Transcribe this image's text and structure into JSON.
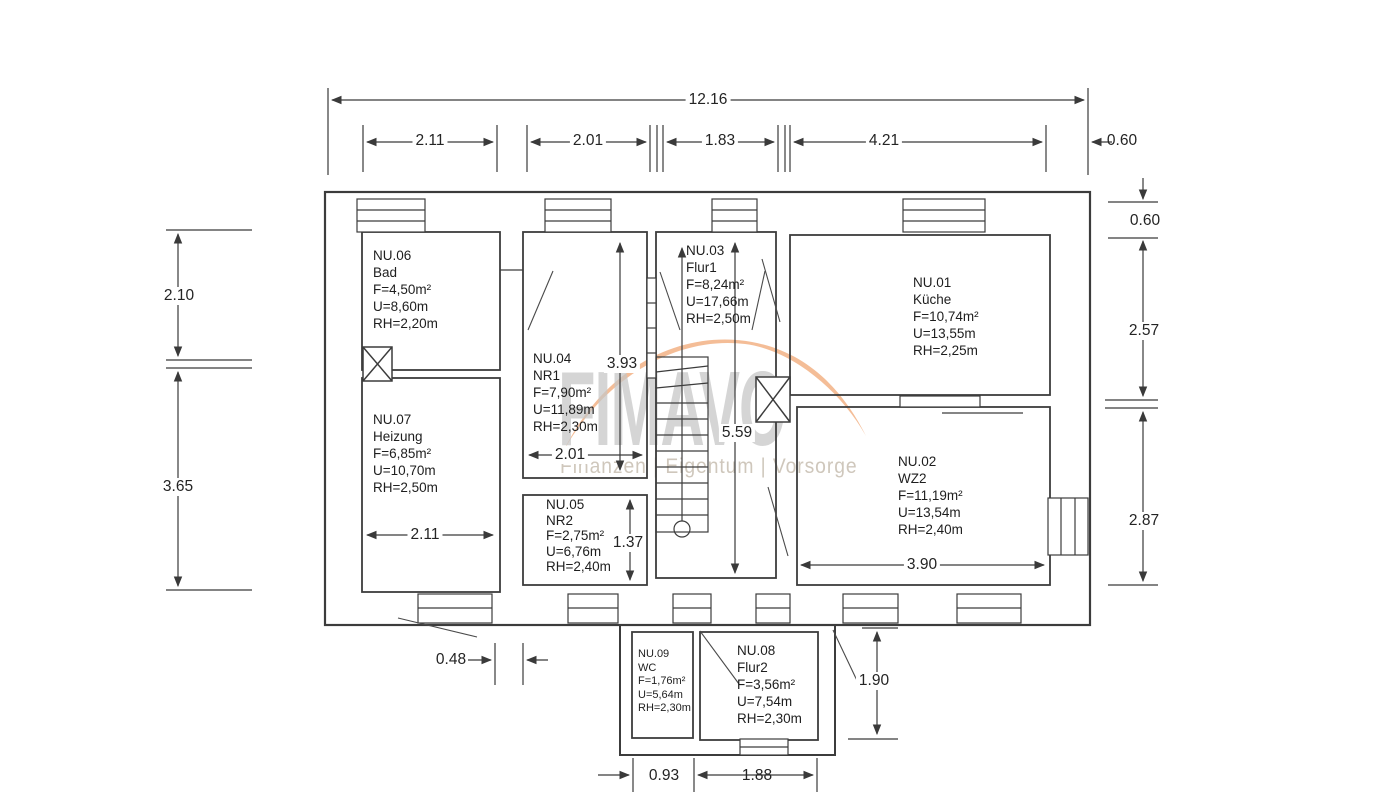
{
  "watermark": {
    "brand": "FIMAVO",
    "tagline": "Finanzen | Eigentum | Vorsorge",
    "accent_color": "#f2b285",
    "text_color": "#c6c6c6"
  },
  "rooms": {
    "nu01": {
      "id": "NU.01",
      "name": "Küche",
      "area": "F=10,74m²",
      "perimeter": "U=13,55m",
      "height": "RH=2,25m"
    },
    "nu02": {
      "id": "NU.02",
      "name": "WZ2",
      "area": "F=11,19m²",
      "perimeter": "U=13,54m",
      "height": "RH=2,40m"
    },
    "nu03": {
      "id": "NU.03",
      "name": "Flur1",
      "area": "F=8,24m²",
      "perimeter": "U=17,66m",
      "height": "RH=2,50m"
    },
    "nu04": {
      "id": "NU.04",
      "name": "NR1",
      "area": "F=7,90m²",
      "perimeter": "U=11,89m",
      "height": "RH=2,30m"
    },
    "nu05": {
      "id": "NU.05",
      "name": "NR2",
      "area": "F=2,75m²",
      "perimeter": "U=6,76m",
      "height": "RH=2,40m"
    },
    "nu06": {
      "id": "NU.06",
      "name": "Bad",
      "area": "F=4,50m²",
      "perimeter": "U=8,60m",
      "height": "RH=2,20m"
    },
    "nu07": {
      "id": "NU.07",
      "name": "Heizung",
      "area": "F=6,85m²",
      "perimeter": "U=10,70m",
      "height": "RH=2,50m"
    },
    "nu08": {
      "id": "NU.08",
      "name": "Flur2",
      "area": "F=3,56m²",
      "perimeter": "U=7,54m",
      "height": "RH=2,30m"
    },
    "nu09": {
      "id": "NU.09",
      "name": "WC",
      "area": "F=1,76m²",
      "perimeter": "U=5,64m",
      "height": "RH=2,30m"
    }
  },
  "dimensions": {
    "total_width": "12.16",
    "top_segments": [
      "2.11",
      "2.01",
      "1.83",
      "4.21",
      "0.60"
    ],
    "left": [
      "2.10",
      "3.65"
    ],
    "right": [
      "0.60",
      "2.57",
      "2.87"
    ],
    "nr1_height": "3.93",
    "hall_height": "5.59",
    "nr1_width": "2.01",
    "heizung_width": "2.11",
    "nr2_height": "1.37",
    "wz2_width": "3.90",
    "left_offset": "0.48",
    "annex_height": "1.90",
    "wc_width": "0.93",
    "flur2_width": "1.88"
  }
}
